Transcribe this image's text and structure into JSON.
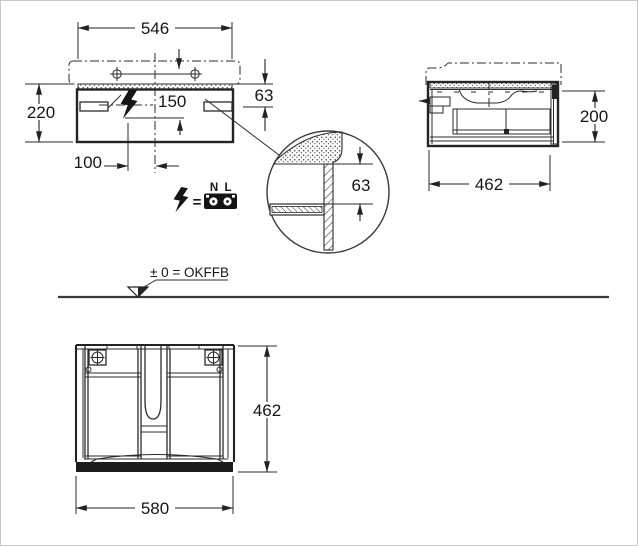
{
  "front_view": {
    "basin_width": "546",
    "cabinet_height": "220",
    "rim_height": "63",
    "outlet_offset_center": "150",
    "outlet_offset_left": "100"
  },
  "electrical_legend": {
    "equals": "=",
    "terminal_neutral": "N",
    "terminal_line": "L"
  },
  "detail_view": {
    "rail_offset": "63"
  },
  "side_view": {
    "cabinet_height": "200",
    "cabinet_depth": "462"
  },
  "ground": {
    "level_label": "± 0 = OKFFB"
  },
  "plan_view": {
    "cabinet_depth": "462",
    "cabinet_width": "580"
  }
}
